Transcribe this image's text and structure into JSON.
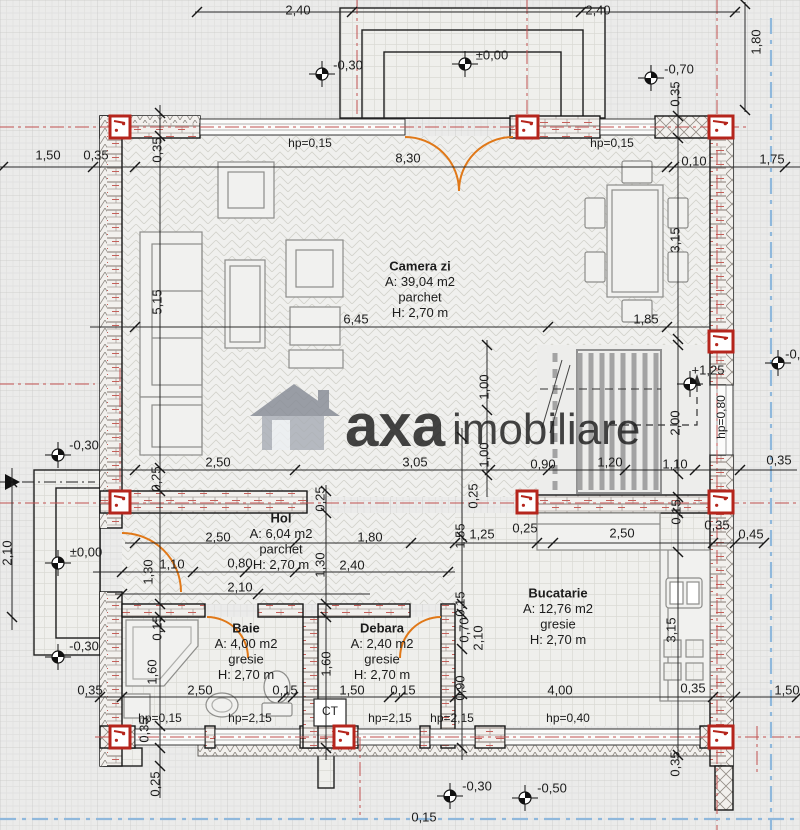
{
  "watermark": {
    "brand": "axa",
    "suffix": "imobiliare"
  },
  "rooms": [
    {
      "name": "Camera zi",
      "area": "A: 39,04 m2",
      "floor": "parchet",
      "height": "H: 2,70 m"
    },
    {
      "name": "Hol",
      "area": "A: 6,04 m2",
      "floor": "parchet",
      "height": "H: 2,70 m"
    },
    {
      "name": "Baie",
      "area": "A: 4,00 m2",
      "floor": "gresie",
      "height": "H: 2,70 m"
    },
    {
      "name": "Debara",
      "area": "A: 2,40 m2",
      "floor": "gresie",
      "height": "H: 2,70 m"
    },
    {
      "name": "Bucatarie",
      "area": "A: 12,76 m2",
      "floor": "gresie",
      "height": "H: 2,70 m"
    }
  ],
  "levels": [
    {
      "t": "-0,30",
      "sx": 322,
      "sy": 74,
      "lx": 348,
      "ly": 66
    },
    {
      "t": "±0,00",
      "sx": 465,
      "sy": 64,
      "lx": 492,
      "ly": 56
    },
    {
      "t": "-0,70",
      "sx": 651,
      "sy": 78,
      "lx": 679,
      "ly": 70
    },
    {
      "t": "-0,30",
      "sx": 58,
      "sy": 455,
      "lx": 84,
      "ly": 446
    },
    {
      "t": "±0,00",
      "sx": 58,
      "sy": 563,
      "lx": 86,
      "ly": 553
    },
    {
      "t": "-0,30",
      "sx": 58,
      "sy": 657,
      "lx": 84,
      "ly": 647
    },
    {
      "t": "+1,25",
      "sx": 690,
      "sy": 384,
      "lx": 708,
      "ly": 371
    },
    {
      "t": "-0,30",
      "sx": 450,
      "sy": 796,
      "lx": 477,
      "ly": 787
    },
    {
      "t": "-0,50",
      "sx": 525,
      "sy": 798,
      "lx": 552,
      "ly": 789
    },
    {
      "t": "-0,30",
      "sx": 778,
      "sy": 363,
      "lx": 800,
      "ly": 355
    }
  ],
  "dim_labels": [
    {
      "t": "2,40",
      "x": 298,
      "y": 11
    },
    {
      "t": "2,40",
      "x": 598,
      "y": 11
    },
    {
      "t": "1,80",
      "x": 757,
      "y": 42,
      "r": 1
    },
    {
      "t": "1,50",
      "x": 48,
      "y": 156
    },
    {
      "t": "0,35",
      "x": 96,
      "y": 156
    },
    {
      "t": "8,30",
      "x": 408,
      "y": 159
    },
    {
      "t": "0,10",
      "x": 694,
      "y": 162
    },
    {
      "t": "1,75",
      "x": 772,
      "y": 160
    },
    {
      "t": "hp=0,15",
      "x": 310,
      "y": 144,
      "s": 12
    },
    {
      "t": "hp=0,15",
      "x": 612,
      "y": 144,
      "s": 12
    },
    {
      "t": "0,35",
      "x": 158,
      "y": 150,
      "r": 1
    },
    {
      "t": "0,35",
      "x": 676,
      "y": 94,
      "r": 1
    },
    {
      "t": "5,15",
      "x": 158,
      "y": 302,
      "r": 1
    },
    {
      "t": "3,15",
      "x": 676,
      "y": 240,
      "r": 1
    },
    {
      "t": "6,45",
      "x": 356,
      "y": 320
    },
    {
      "t": "1,85",
      "x": 646,
      "y": 320
    },
    {
      "t": "hp=0,80",
      "x": 722,
      "y": 417,
      "r": 1,
      "s": 12
    },
    {
      "t": "2,00",
      "x": 676,
      "y": 423,
      "r": 1
    },
    {
      "t": "1,00",
      "x": 485,
      "y": 387,
      "r": 1
    },
    {
      "t": "1,00",
      "x": 485,
      "y": 455,
      "r": 1
    },
    {
      "t": "2,50",
      "x": 218,
      "y": 463
    },
    {
      "t": "3,05",
      "x": 415,
      "y": 463
    },
    {
      "t": "0,90",
      "x": 543,
      "y": 465
    },
    {
      "t": "1,20",
      "x": 610,
      "y": 463
    },
    {
      "t": "1,10",
      "x": 675,
      "y": 465
    },
    {
      "t": "0,35",
      "x": 779,
      "y": 461
    },
    {
      "t": "0,25",
      "x": 157,
      "y": 479,
      "r": 1
    },
    {
      "t": "0,25",
      "x": 321,
      "y": 499,
      "r": 1
    },
    {
      "t": "0,25",
      "x": 474,
      "y": 496,
      "r": 1
    },
    {
      "t": "0,15",
      "x": 677,
      "y": 512,
      "r": 1
    },
    {
      "t": "2,50",
      "x": 218,
      "y": 538
    },
    {
      "t": "1,80",
      "x": 370,
      "y": 538
    },
    {
      "t": "1,10",
      "x": 172,
      "y": 565
    },
    {
      "t": "0,80",
      "x": 240,
      "y": 564
    },
    {
      "t": "2,40",
      "x": 352,
      "y": 566
    },
    {
      "t": "2,10",
      "x": 240,
      "y": 588
    },
    {
      "t": "1,30",
      "x": 149,
      "y": 572,
      "r": 1
    },
    {
      "t": "1,30",
      "x": 321,
      "y": 565,
      "r": 1
    },
    {
      "t": "2,10",
      "x": 8,
      "y": 553,
      "r": 1
    },
    {
      "t": "1,25",
      "x": 482,
      "y": 535
    },
    {
      "t": "0,25",
      "x": 525,
      "y": 529
    },
    {
      "t": "2,50",
      "x": 622,
      "y": 534
    },
    {
      "t": "0,35",
      "x": 717,
      "y": 526
    },
    {
      "t": "0,45",
      "x": 751,
      "y": 535
    },
    {
      "t": "1,55",
      "x": 461,
      "y": 536,
      "r": 1
    },
    {
      "t": "0,15",
      "x": 461,
      "y": 604,
      "r": 1
    },
    {
      "t": "0,70",
      "x": 465,
      "y": 630,
      "r": 1
    },
    {
      "t": "2,10",
      "x": 479,
      "y": 638,
      "r": 1
    },
    {
      "t": "0,90",
      "x": 461,
      "y": 688,
      "r": 1
    },
    {
      "t": "3,15",
      "x": 672,
      "y": 630,
      "r": 1
    },
    {
      "t": "0,15",
      "x": 158,
      "y": 628,
      "r": 1
    },
    {
      "t": "1,60",
      "x": 153,
      "y": 672,
      "r": 1
    },
    {
      "t": "1,60",
      "x": 327,
      "y": 664,
      "r": 1
    },
    {
      "t": "0,35",
      "x": 90,
      "y": 691
    },
    {
      "t": "2,50",
      "x": 200,
      "y": 691
    },
    {
      "t": "0,15",
      "x": 285,
      "y": 691
    },
    {
      "t": "1,50",
      "x": 352,
      "y": 691
    },
    {
      "t": "0,15",
      "x": 403,
      "y": 691
    },
    {
      "t": "4,00",
      "x": 560,
      "y": 691
    },
    {
      "t": "0,35",
      "x": 693,
      "y": 689
    },
    {
      "t": "1,50",
      "x": 787,
      "y": 691
    },
    {
      "t": "hp=0,15",
      "x": 160,
      "y": 719,
      "s": 12
    },
    {
      "t": "hp=2,15",
      "x": 250,
      "y": 719,
      "s": 12
    },
    {
      "t": "hp=2,15",
      "x": 390,
      "y": 719,
      "s": 12
    },
    {
      "t": "hp=2,15",
      "x": 452,
      "y": 719,
      "s": 12
    },
    {
      "t": "hp=0,40",
      "x": 568,
      "y": 719,
      "s": 12
    },
    {
      "t": "CT",
      "x": 330,
      "y": 712,
      "s": 12
    },
    {
      "t": "0,35",
      "x": 145,
      "y": 730,
      "r": 1
    },
    {
      "t": "0,25",
      "x": 156,
      "y": 784,
      "r": 1
    },
    {
      "t": "0,35",
      "x": 676,
      "y": 764,
      "r": 1
    },
    {
      "t": "0,15",
      "x": 424,
      "y": 818
    }
  ],
  "colors": {
    "column_red": "#b5251c",
    "door_orange": "#e07818",
    "axis_red": "#c25050",
    "axis_blue": "#8fb8dc",
    "watermark_gray": "#9b9b9b",
    "watermark_red": "#d98585"
  }
}
